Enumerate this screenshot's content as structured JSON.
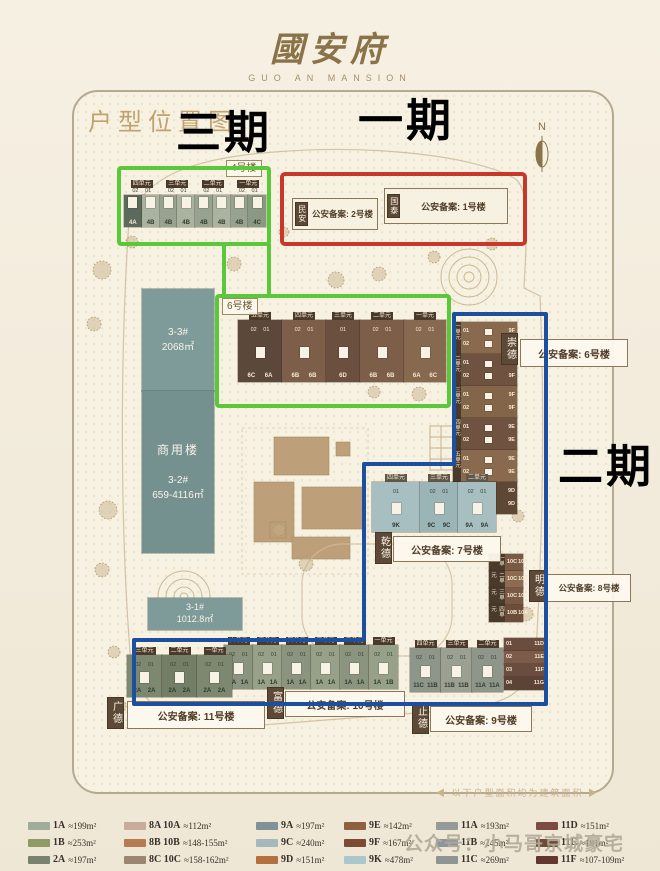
{
  "page": {
    "watermark": "公众号：小马哥京城豪宅",
    "footnote": "◀ 以下户型面积均为建筑面积 ▶"
  },
  "header": {
    "logo_cn": "國安府",
    "logo_en": "GUO AN MANSION"
  },
  "map": {
    "title": "户型位置图",
    "compass": "N",
    "phases": {
      "p1": {
        "label": "一期",
        "color": "#c7382a"
      },
      "p2": {
        "label": "二期",
        "color": "#1d4fa1"
      },
      "p3": {
        "label": "三期",
        "color": "#5bc83a"
      }
    },
    "b4": {
      "tag": "4号楼",
      "units": [
        "四单元",
        "三单元",
        "二单元",
        "一单元"
      ],
      "doors": "02 01",
      "cells": [
        "4A",
        "4B",
        "4B",
        "4B",
        "4B",
        "4B",
        "4B",
        "4C"
      ]
    },
    "ph1": {
      "b2": {
        "name": "民安",
        "filing": "公安备案: 2号楼"
      },
      "b1": {
        "name": "国泰",
        "filing": "公安备案: 1号楼"
      }
    },
    "b6": {
      "tag": "6号楼",
      "sections": [
        {
          "name": "五单元",
          "doors": "02 01",
          "cells": [
            "6C",
            "6A"
          ]
        },
        {
          "name": "四单元",
          "doors": "02 01",
          "cells": [
            "6B",
            "6B"
          ]
        },
        {
          "name": "三单元",
          "doors": "01",
          "cells": [
            "6D"
          ]
        },
        {
          "name": "二单元",
          "doors": "02 01",
          "cells": [
            "6B",
            "6B"
          ]
        },
        {
          "name": "一单元",
          "doors": "02 01",
          "cells": [
            "6A",
            "6C"
          ]
        }
      ]
    },
    "commercial": {
      "b33": {
        "id": "3-3#",
        "area": "2068㎡"
      },
      "b32": {
        "name": "商用楼",
        "id": "3-2#",
        "area": "659-4116㎡"
      },
      "b31": {
        "id": "3-1#",
        "area": "1012.8㎡"
      }
    },
    "chongde": {
      "name": "崇德",
      "filing": "公安备案: 6号楼",
      "sections": [
        {
          "name": "一单元",
          "rows": [
            [
              "01",
              "9F"
            ],
            [
              "02",
              "9F"
            ]
          ]
        },
        {
          "name": "二单元",
          "rows": [
            [
              "01",
              "9F"
            ],
            [
              "02",
              "9F"
            ]
          ]
        },
        {
          "name": "三单元",
          "rows": [
            [
              "01",
              "9F"
            ],
            [
              "02",
              "9F"
            ]
          ]
        },
        {
          "name": "四单元",
          "rows": [
            [
              "01",
              "9E"
            ],
            [
              "02",
              "9E"
            ]
          ]
        },
        {
          "name": "五单元",
          "rows": [
            [
              "01",
              "9E"
            ],
            [
              "02",
              "9E"
            ]
          ]
        },
        {
          "name": "六单元",
          "rows": [
            [
              "01",
              "9D"
            ],
            [
              "02",
              "9D"
            ]
          ]
        }
      ]
    },
    "qiande": {
      "name": "乾德",
      "filing": "公安备案: 7号楼",
      "sections": [
        {
          "name": "四单元",
          "doors": "01",
          "cells": [
            "9K"
          ]
        },
        {
          "name": "三单元",
          "doors": "02 01",
          "cells": [
            "9C",
            "9C"
          ]
        },
        {
          "name": "二单元",
          "doors": "02 01",
          "cells": [
            "9A",
            "9A"
          ]
        }
      ]
    },
    "mingde": {
      "name": "明德",
      "filing": "公安备案: 8号楼",
      "sections": [
        {
          "name": "一单元",
          "rows": [
            [
              "01",
              "10C"
            ],
            [
              "02",
              "10C"
            ]
          ]
        },
        {
          "name": "二单元",
          "rows": [
            [
              "01",
              "10C"
            ],
            [
              "02",
              "10C"
            ]
          ]
        },
        {
          "name": "三单元",
          "rows": [
            [
              "01",
              "10C"
            ],
            [
              "02",
              "10C"
            ]
          ]
        },
        {
          "name": "四单元",
          "rows": [
            [
              "01",
              "10B"
            ],
            [
              "02",
              "10A"
            ]
          ]
        }
      ]
    },
    "zhide": {
      "name": "止德",
      "filing": "公安备案: 9号楼",
      "sections": [
        {
          "name": "四单元",
          "doors": "02 01",
          "cells": [
            "11C",
            "11B"
          ]
        },
        {
          "name": "三单元",
          "doors": "02 01",
          "cells": [
            "11B",
            "11B"
          ]
        },
        {
          "name": "二单元",
          "doors": "02 01",
          "cells": [
            "11A",
            "11A"
          ]
        }
      ],
      "wing": {
        "name": "一单元",
        "rows": [
          [
            "01",
            "11D"
          ],
          [
            "02",
            "11E"
          ],
          [
            "03",
            "11F"
          ],
          [
            "04",
            "11G"
          ]
        ]
      }
    },
    "fude": {
      "name": "富德",
      "filing": "公安备案: 10号楼",
      "sections": [
        {
          "name": "六单元",
          "doors": "02 01",
          "cells": [
            "1A",
            "1A"
          ]
        },
        {
          "name": "五单元",
          "doors": "02 01",
          "cells": [
            "1A",
            "1A"
          ]
        },
        {
          "name": "四单元",
          "doors": "02 01",
          "cells": [
            "1A",
            "1A"
          ]
        },
        {
          "name": "三单元",
          "doors": "02 01",
          "cells": [
            "1A",
            "1A"
          ]
        },
        {
          "name": "二单元",
          "doors": "02 01",
          "cells": [
            "1A",
            "1A"
          ]
        },
        {
          "name": "一单元",
          "doors": "02 01",
          "cells": [
            "1A",
            "1B"
          ]
        }
      ]
    },
    "guangde": {
      "name": "广德",
      "filing": "公安备案: 11号楼",
      "sections": [
        {
          "name": "三单元",
          "doors": "02 01",
          "cells": [
            "2A",
            "2A"
          ]
        },
        {
          "name": "二单元",
          "doors": "02 01",
          "cells": [
            "2A",
            "2A"
          ]
        },
        {
          "name": "一单元",
          "doors": "02 01",
          "cells": [
            "2A",
            "2A"
          ]
        }
      ]
    }
  },
  "legend": {
    "columns": [
      [
        {
          "code": "1A",
          "area": "≈199m²",
          "color": "#9fab9b"
        },
        {
          "code": "1B",
          "area": "≈253m²",
          "color": "#8f9a66"
        },
        {
          "code": "2A",
          "area": "≈197m²",
          "color": "#77826f"
        }
      ],
      [
        {
          "code": "8A 10A",
          "area": "≈112m²",
          "color": "#c9ab9b"
        },
        {
          "code": "8B 10B",
          "area": "≈148-155m²",
          "color": "#b57c51"
        },
        {
          "code": "8C 10C",
          "area": "≈158-162m²",
          "color": "#9a8671"
        }
      ],
      [
        {
          "code": "9A",
          "area": "≈197m²",
          "color": "#7e9297"
        },
        {
          "code": "9C",
          "area": "≈240m²",
          "color": "#a5b8ba"
        },
        {
          "code": "9D",
          "area": "≈151m²",
          "color": "#b4713f"
        }
      ],
      [
        {
          "code": "9E",
          "area": "≈142m²",
          "color": "#8f603f"
        },
        {
          "code": "9F",
          "area": "≈167m²",
          "color": "#7c4b34"
        },
        {
          "code": "9K",
          "area": "≈478m²",
          "color": "#aac7ce"
        }
      ],
      [
        {
          "code": "11A",
          "area": "≈193m²",
          "color": "#949a98"
        },
        {
          "code": "11B",
          "area": "≈245m²",
          "color": "#8a959b"
        },
        {
          "code": "11C",
          "area": "≈269m²",
          "color": "#8f9594"
        }
      ],
      [
        {
          "code": "11D",
          "area": "≈151m²",
          "color": "#7d4b43"
        },
        {
          "code": "11E",
          "area": "≈191m²",
          "color": "#6d4a39"
        },
        {
          "code": "11F",
          "area": "≈107-109m²",
          "color": "#63372f"
        }
      ]
    ]
  }
}
